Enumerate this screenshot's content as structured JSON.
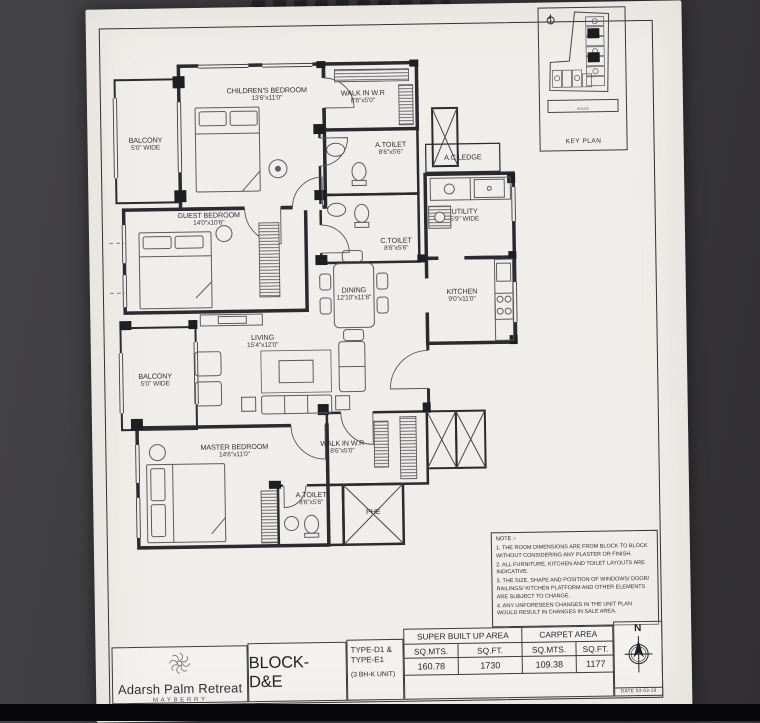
{
  "plan": {
    "rooms": [
      {
        "name": "CHILDREN'S BEDROOM",
        "dims": "13'6\"x11'0\""
      },
      {
        "name": "WALK IN  W.R",
        "dims": "8'6\"x5'0\""
      },
      {
        "name": "BALCONY",
        "dims": "5'0\" WIDE"
      },
      {
        "name": "A.TOILET",
        "dims": "8'6\"x5'6\""
      },
      {
        "name": "A.C LEDGE",
        "dims": ""
      },
      {
        "name": "UTILITY",
        "dims": "5'9\" WIDE"
      },
      {
        "name": "C.TOILET",
        "dims": "8'6\"x5'6\""
      },
      {
        "name": "KITCHEN",
        "dims": "9'0\"x11'0\""
      },
      {
        "name": "GUEST BEDROOM",
        "dims": "14'0\"x10'6\""
      },
      {
        "name": "DINING",
        "dims": "12'10\"x11'8\""
      },
      {
        "name": "LIVING",
        "dims": "15'4\"x12'0\""
      },
      {
        "name": "BALCONY",
        "dims": "5'0\" WIDE"
      },
      {
        "name": "MASTER BEDROOM",
        "dims": "14'6\"x11'0\""
      },
      {
        "name": "WALK IN  W.R",
        "dims": "8'6\"x5'0\""
      },
      {
        "name": "A.TOILET",
        "dims": "8'6\"x5'6\""
      },
      {
        "name": "PHE",
        "dims": ""
      }
    ]
  },
  "key_plan": {
    "title": "KEY PLAN",
    "road": "ROAD"
  },
  "notes": {
    "heading": "NOTE :-",
    "items": [
      "1. THE ROOM DIMENSIONS ARE FROM BLOCK TO BLOCK WITHOUT CONSIDERING ANY PLASTER OR FINISH.",
      "2. ALL FURNITURE, KITCHEN AND TOILET LAYOUTS ARE INDICATIVE.",
      "3. THE SIZE, SHAPE AND POSITION OF WINDOWS/ DOOR/ RAILINGS/ KITCHEN PLATFORM AND OTHER ELEMENTS ARE SUBJECT TO CHANGE.",
      "4. ANY UNFORESEEN CHANGES IN THE UNIT PLAN WOULD RESULT IN CHANGES IN SALE AREA."
    ]
  },
  "footer": {
    "brand": {
      "name": "Adarsh Palm Retreat",
      "word": "MAYBERRY"
    },
    "block_label": "BLOCK- D&E",
    "unit_type": {
      "line1": "TYPE-D1 &",
      "line2": "TYPE-E1",
      "line3": "(3 BH-K UNIT)"
    },
    "area_table": {
      "super_header": "SUPER BUILT UP AREA",
      "carpet_header": "CARPET AREA",
      "col_headers": [
        "SQ.MTS.",
        "SQ.FT.",
        "SQ.MTS.",
        "SQ.FT."
      ],
      "values": [
        "160.78",
        "1730",
        "109.38",
        "1177"
      ]
    },
    "compass_n": "N",
    "date": "DATE  03-03-18"
  },
  "colors": {
    "paper": "#f0eeea",
    "ink": "#2b2b2f",
    "background": "#3b3a3d"
  }
}
